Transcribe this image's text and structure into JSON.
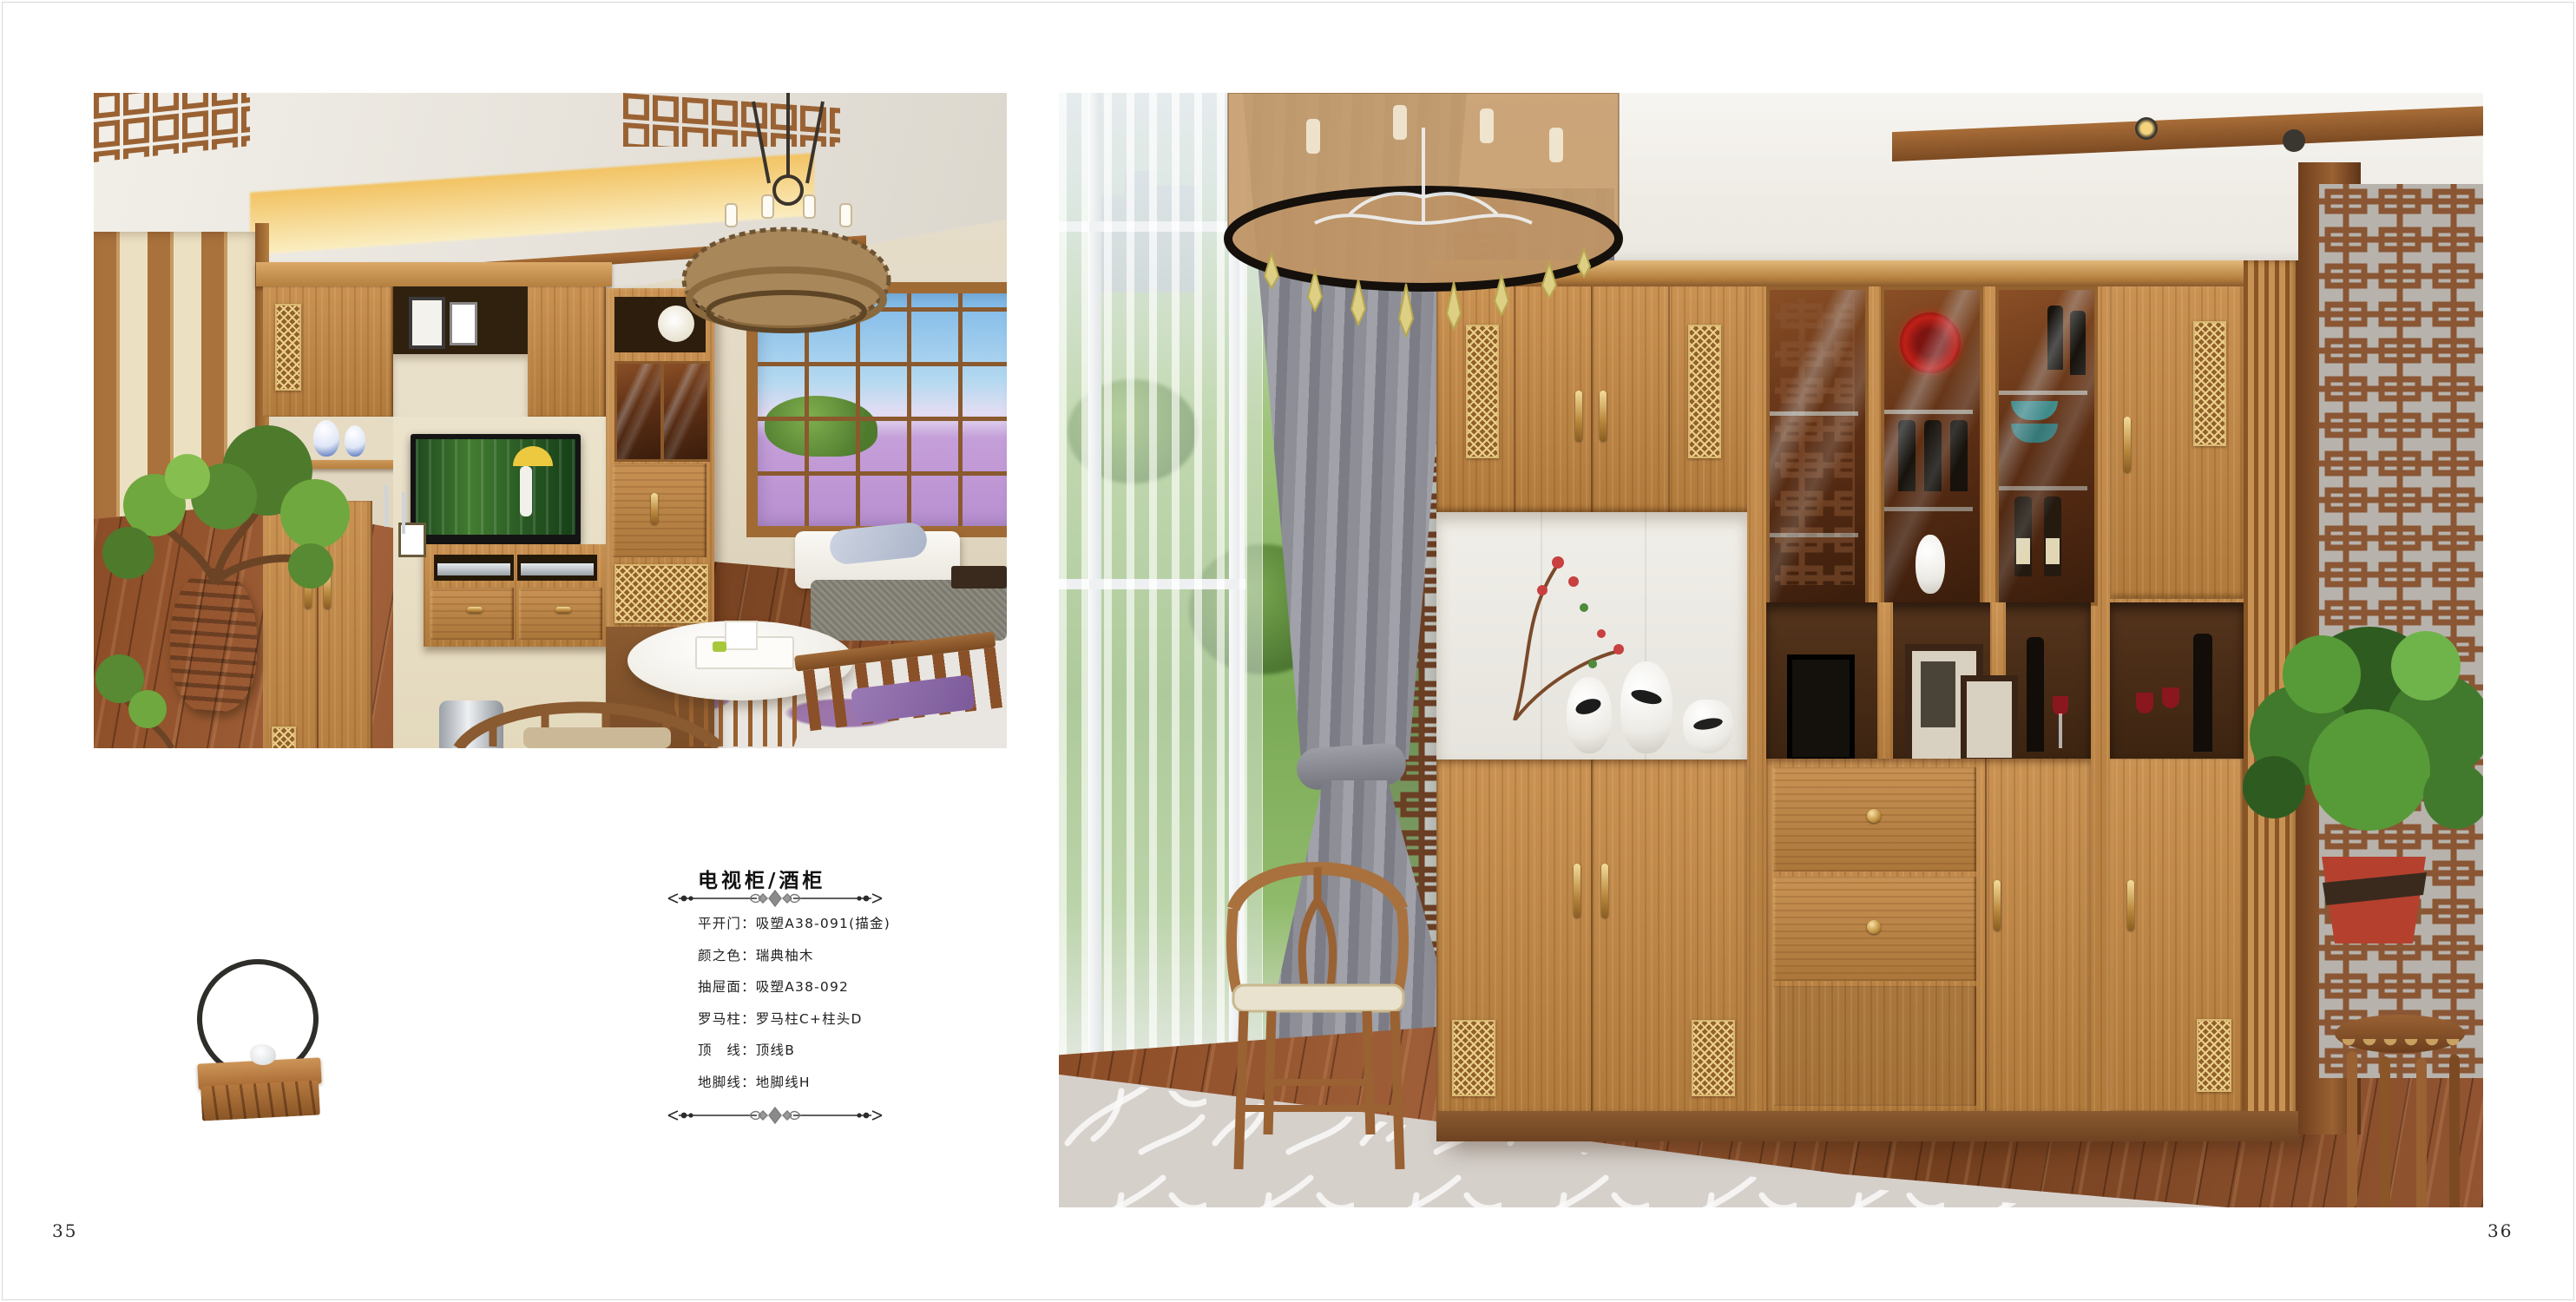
{
  "page": {
    "number_left": "35",
    "number_right": "36"
  },
  "catalog": {
    "title": "电视柜/酒柜",
    "specs": [
      "平开门：吸塑A38-091(描金)",
      "颜之色：瑞典柚木",
      "抽屉面：吸塑A38-092",
      "罗马柱：罗马柱C+柱头D",
      "顶　线：顶线B",
      "地脚线：地脚线H"
    ]
  },
  "colors": {
    "cabinet_wood": "#c08a4a",
    "wood_dark": "#8a5a30",
    "accent_gold": "#d9b871",
    "lavender_field": "#b88fd0",
    "curtain_gray": "#8e8f97",
    "rug_gray": "#d6d0cb",
    "floor_wood": "#7a4226",
    "text": "#1f1f1f"
  },
  "icons": {
    "divider": "ornamental-rule-icon"
  }
}
